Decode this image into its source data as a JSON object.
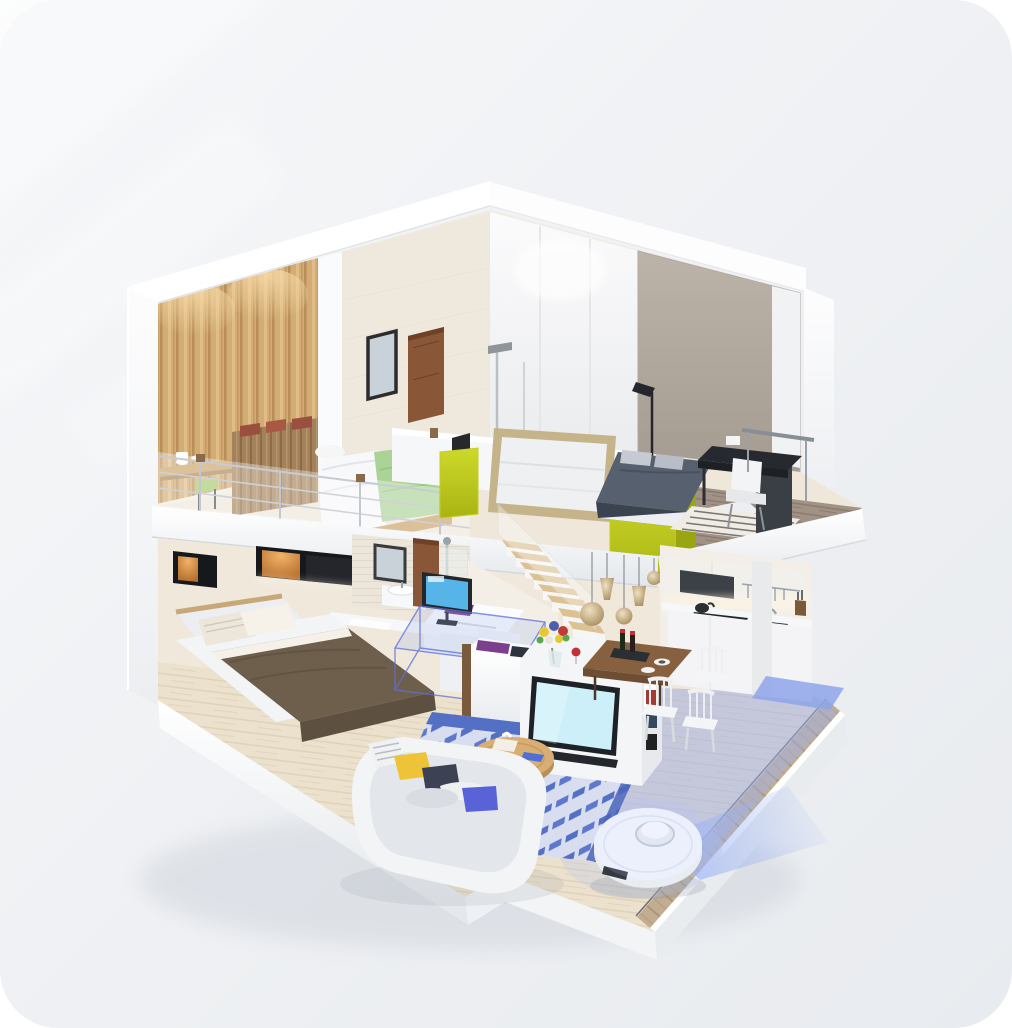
{
  "meta": {
    "description": "Isometric 3D cutaway render of a two-story loft apartment; a white robot vacuum with LiDAR turret cleans the lower floor, blue translucent overlays mark mapped/cleaned areas and virtual zones. No text appears in the image.",
    "render_type": "product-marketing-3d-render"
  },
  "colors": {
    "page": "#ffffff",
    "card": "#eef0f3",
    "card_light": "#f7f8fa",
    "slab": "#ffffff",
    "slab_side": "#e6e9ed",
    "slab_deep": "#d9dde2",
    "upper_wall": "#f1ece2",
    "wall_cream": "#efe8dc",
    "wall_taupe": "#b2a99f",
    "wood_wall": "#d3ab74",
    "wood_dark": "#8a6a48",
    "bench_wood": "#a3815a",
    "green_blanket": "#abd396",
    "duvet": "#f7f8fa",
    "lime": "#c3cf1e",
    "board_frame": "#c5b48a",
    "board_face": "#eef0f2",
    "navy_bed": "#57606f",
    "navy_dark": "#3b4250",
    "desk_black": "#26292f",
    "chair_white": "#f2f4f6",
    "deck_wood": "#a29285",
    "door_wood": "#8a5638",
    "mirror_glass": "#c9d2d8",
    "cabinet_black": "#17181c",
    "cabinet_glow": "#e9a85c",
    "stair_tread": "#dcc192",
    "lamp_amber": "#c9ad7e",
    "counter": "#f6f7f8",
    "cooktop": "#22262b",
    "hood": "#3c4047",
    "island": "#f4f5f7",
    "table_wood": "#87613f",
    "tv_screen": "#cdeffa",
    "monitor_screen": "#57b4e8",
    "blanket_brown": "#6e5f4d",
    "pillow": "#ece6db",
    "rug_blue": "#5470c4",
    "rug_light": "#d8def0",
    "floor_wood": "#ebe1cc",
    "floor_blue": "#9fb0ea",
    "zone_blue": "#8ea4ea",
    "sofa": "#f3f4f6",
    "cushion_yellow": "#eec337",
    "cushion_navy": "#3c4254",
    "cushion_violet": "#5a62d8",
    "plant_green": "#4f9e3c",
    "plant_pot": "#8d3a62",
    "stool_blue": "#3ab1e4",
    "coffee_table": "#d9ae74",
    "robot_body": "#fbfcfe",
    "robot_detail": "#343a40",
    "fan_blue": "#9db4f2",
    "strip_wood": "#c2ad90",
    "metal": "#9aa3ab"
  },
  "scene": {
    "background": {
      "label": "soft light-gray rounded card with faint diagonal light streaks"
    },
    "structure": {
      "roof": "white peaked roof slab",
      "left_wall": "thick white cutaway wall",
      "right_wall": "white cutaway wall",
      "base": "stepped white base slab"
    },
    "upper_floor": {
      "label": "loft level",
      "objects": [
        {
          "name": "wood-accent-wall",
          "color": "#d3ab74"
        },
        {
          "name": "loft-study-desk",
          "items": [
            "cups"
          ]
        },
        {
          "name": "wood-bench-headboard",
          "cushions": "rust-red"
        },
        {
          "name": "loft-bed",
          "blanket": "#abd396",
          "duvet": "white"
        },
        {
          "name": "glass-railing",
          "posts": "wood-capped"
        },
        {
          "name": "wall-mirror",
          "frame": "black"
        },
        {
          "name": "wood-door",
          "color": "#8a5638"
        },
        {
          "name": "shower-column",
          "finish": "chrome"
        },
        {
          "name": "presentation-board",
          "frame": "#c5b48a"
        },
        {
          "name": "lime-ottoman-small",
          "color": "#c3cf1e",
          "item": "black tablet"
        },
        {
          "name": "lime-ottoman-large",
          "color": "#c3cf1e"
        },
        {
          "name": "black-floor-lamp"
        },
        {
          "name": "double-bed-navy",
          "color": "#57606f"
        },
        {
          "name": "striped-rug"
        },
        {
          "name": "black-desk-and-white-chair"
        },
        {
          "name": "dark-side-cabinet"
        },
        {
          "name": "cantilevered-wood-deck",
          "color": "#a29285"
        }
      ]
    },
    "lower_floor": {
      "label": "main level",
      "objects": [
        {
          "name": "lit-wall-cabinets",
          "glow": "#e9a85c"
        },
        {
          "name": "single-bed",
          "blanket": "#6e5f4d",
          "pillows": "striped"
        },
        {
          "name": "computer-desk",
          "monitor_screen": "#57b4e8"
        },
        {
          "name": "desk-chair-white"
        },
        {
          "name": "virtual-no-go-zone-box",
          "color": "#8ea4ea"
        },
        {
          "name": "storage-half-wall",
          "items": [
            "purple cloth",
            "navy cloth",
            "yellow towel"
          ]
        },
        {
          "name": "potted-palm",
          "pot": "#8d3a62"
        },
        {
          "name": "bathroom",
          "items": [
            "mirror",
            "sink",
            "shower",
            "wood door"
          ]
        },
        {
          "name": "staircase",
          "treads": "#dcc192"
        },
        {
          "name": "pendant-lamps",
          "count": 5,
          "glass": "amber"
        },
        {
          "name": "kitchen",
          "items": [
            "white cabinets",
            "black cooktop",
            "kettle",
            "sink",
            "hood",
            "utensil rail",
            "knives"
          ]
        },
        {
          "name": "kitchen-island",
          "items": [
            "tv",
            "bookshelf",
            "flowers",
            "wine"
          ]
        },
        {
          "name": "dining-table",
          "chairs": 3
        },
        {
          "name": "geometric-rug",
          "colors": [
            "#5470c4",
            "#d8def0"
          ]
        },
        {
          "name": "coffee-table",
          "items": [
            "tissue box",
            "blue book"
          ]
        },
        {
          "name": "blue-stool",
          "color": "#3ab1e4"
        },
        {
          "name": "white-curved-sofa",
          "cushions": [
            "striped",
            "yellow",
            "navy",
            "violet"
          ]
        },
        {
          "name": "cleaned-area-overlay",
          "color": "#9fb0ea"
        },
        {
          "name": "virtual-zone-plane",
          "color": "#8ea4ea"
        }
      ]
    },
    "robot": {
      "label": "robot vacuum",
      "body_color": "#fbfcfe",
      "features": [
        "lidar-turret",
        "front-sensor-port",
        "blue-scan-fan"
      ]
    }
  }
}
